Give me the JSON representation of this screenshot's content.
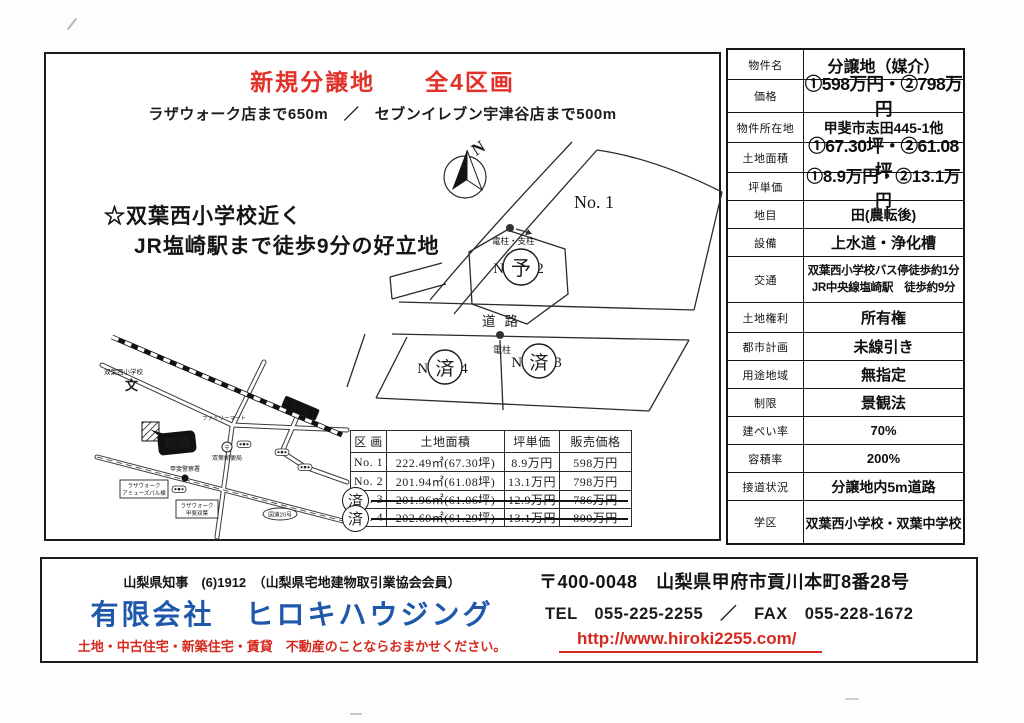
{
  "title": "新規分譲地　　全4区画",
  "subtitle": "ラザウォーク店まで650m　／　セブンイレブン宇津谷店まで500m",
  "catch": {
    "line1": "☆双葉西小学校近く",
    "line2": "JR塩崎駅まで徒歩9分の好立地"
  },
  "site_plan": {
    "north_label": "N",
    "lot1_label": "No. 1",
    "lot2_label": "No.2",
    "lot2_stamp": "予",
    "lot3_label": "No.3",
    "lot3_stamp": "済",
    "lot4_label": "No.4",
    "lot4_stamp": "済",
    "road_label": "道路",
    "pole_support_label": "電柱・支柱",
    "pole_label": "電柱"
  },
  "vicinity_map": {
    "school_label": "双葉西小学校",
    "school_symbol": "文",
    "site_label": "現地",
    "familymart_label": "ファミリーマート",
    "post_symbol": "〒",
    "post_label": "双葉郵便局",
    "police_label": "甲斐警察署",
    "station_label": "塩崎駅",
    "lazawalk_annex_line1": "ラザウォーク",
    "lazawalk_annex_line2": "アミューズパル棟",
    "lazawalk_main_line1": "ラザウォーク",
    "lazawalk_main_line2": "甲斐双葉",
    "route_label": "国道20号"
  },
  "price_table": {
    "headers": [
      "区 画",
      "土地面積",
      "坪単価",
      "販売価格"
    ],
    "rows": [
      {
        "no": "No. 1",
        "area": "222.49㎡(67.30坪)",
        "unit": "8.9万円",
        "price": "598万円",
        "stamp": ""
      },
      {
        "no": "No. 2",
        "area": "201.94㎡(61.08坪)",
        "unit": "13.1万円",
        "price": "798万円",
        "stamp": ""
      },
      {
        "no": "No. 3",
        "area": "201.96㎡(61.06坪)",
        "unit": "12.9万円",
        "price": "786万円",
        "stamp": "済"
      },
      {
        "no": "No. 4",
        "area": "202.60㎡(61.29坪)",
        "unit": "13.1万円",
        "price": "800万円",
        "stamp": "済"
      }
    ]
  },
  "spec_table": {
    "rows": [
      {
        "label": "物件名",
        "value": "分譲地（媒介）"
      },
      {
        "label": "価格",
        "value": "①598万円・②798万円"
      },
      {
        "label": "物件所在地",
        "value": "甲斐市志田445-1他"
      },
      {
        "label": "土地面積",
        "value": "①67.30坪・②61.08坪"
      },
      {
        "label": "坪単価",
        "value": "①8.9万円・②13.1万円"
      },
      {
        "label": "地目",
        "value": "田(農転後)"
      },
      {
        "label": "設備",
        "value": "上水道・浄化槽"
      },
      {
        "label": "交通",
        "value": "双葉西小学校バス停徒歩約1分\nJR中央線塩崎駅　徒歩約9分"
      },
      {
        "label": "土地権利",
        "value": "所有権"
      },
      {
        "label": "都市計画",
        "value": "未線引き"
      },
      {
        "label": "用途地域",
        "value": "無指定"
      },
      {
        "label": "制限",
        "value": "景観法"
      },
      {
        "label": "建ぺい率",
        "value": "70%"
      },
      {
        "label": "容積率",
        "value": "200%"
      },
      {
        "label": "接道状況",
        "value": "分譲地内5m道路"
      },
      {
        "label": "学区",
        "value": "双葉西小学校・双葉中学校"
      }
    ]
  },
  "footer": {
    "license": "山梨県知事　(6)1912　（山梨県宅地建物取引業協会会員）",
    "company": "有限会社　ヒロキハウジング",
    "tagline": "土地・中古住宅・新築住宅・賃貸　不動産のことならおまかせください。",
    "address": "〒400-0048　山梨県甲府市貢川本町8番28号",
    "tel_fax": "TEL　055-225-2255　／　FAX　055-228-1672",
    "url": "http://www.hiroki2255.com/"
  },
  "colors": {
    "title_red": "#e23128",
    "company_blue": "#1f57aa",
    "accent_red": "#d6281e",
    "ink": "#1c1c1c"
  }
}
